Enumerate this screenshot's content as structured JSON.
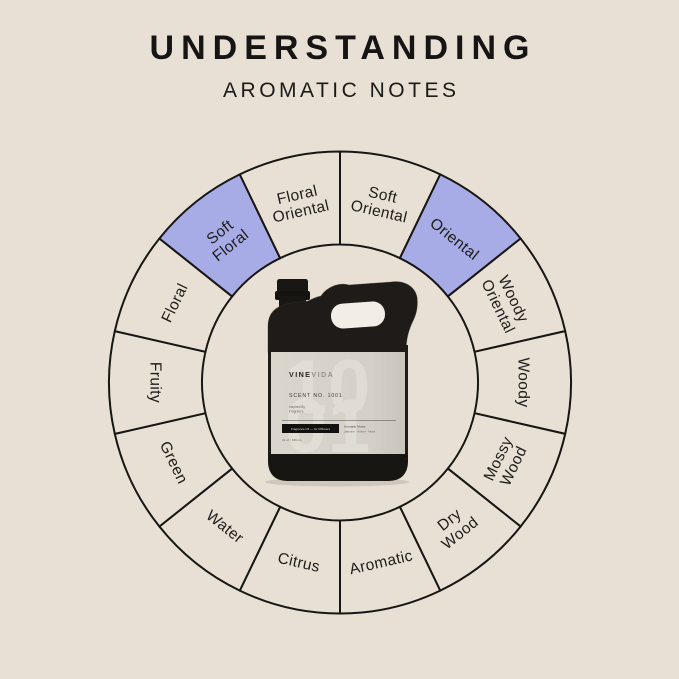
{
  "title": {
    "main": "UNDERSTANDING",
    "subtitle": "AROMATIC NOTES"
  },
  "colors": {
    "background": "#e8e0d4",
    "wheel_fill": "#e8e0d4",
    "highlight_fill": "#a8ace6",
    "line": "#171614",
    "segment_text": "#1d1c1a"
  },
  "wheel": {
    "segment_count": 14,
    "highlighted_labels": [
      "Oriental",
      "Soft Floral"
    ],
    "segments": [
      {
        "label": "Soft Oriental",
        "lines": [
          "Soft",
          "Oriental"
        ],
        "highlighted": false
      },
      {
        "label": "Oriental",
        "lines": [
          "Oriental"
        ],
        "highlighted": true
      },
      {
        "label": "Woody Oriental",
        "lines": [
          "Woody",
          "Oriental"
        ],
        "highlighted": false
      },
      {
        "label": "Woody",
        "lines": [
          "Woody"
        ],
        "highlighted": false
      },
      {
        "label": "Mossy Wood",
        "lines": [
          "Mossy",
          "Wood"
        ],
        "highlighted": false
      },
      {
        "label": "Dry Wood",
        "lines": [
          "Dry",
          "Wood"
        ],
        "highlighted": false
      },
      {
        "label": "Aromatic",
        "lines": [
          "Aromatic"
        ],
        "highlighted": false
      },
      {
        "label": "Citrus",
        "lines": [
          "Citrus"
        ],
        "highlighted": false
      },
      {
        "label": "Water",
        "lines": [
          "Water"
        ],
        "highlighted": false
      },
      {
        "label": "Green",
        "lines": [
          "Green"
        ],
        "highlighted": false
      },
      {
        "label": "Fruity",
        "lines": [
          "Fruity"
        ],
        "highlighted": false
      },
      {
        "label": "Floral",
        "lines": [
          "Floral"
        ],
        "highlighted": false
      },
      {
        "label": "Soft Floral",
        "lines": [
          "Soft",
          "Floral"
        ],
        "highlighted": true
      },
      {
        "label": "Floral Oriental",
        "lines": [
          "Floral",
          "Oriental"
        ],
        "highlighted": false
      }
    ]
  },
  "product": {
    "brand_bold": "VINE",
    "brand_light": "VIDA",
    "scent_line": "SCENT NO. 1001",
    "info_line_1": "Inspired By",
    "info_line_2": "Fragrance",
    "badge_label": "Fragrance Oil — for Diffusers",
    "notes_heading": "Aromatic Notes:",
    "notes_line": "Jasmine · Amber · Musk",
    "volume_line": "32 oz / 946 mL",
    "watermark_top": "10",
    "watermark_bottom": "01"
  }
}
